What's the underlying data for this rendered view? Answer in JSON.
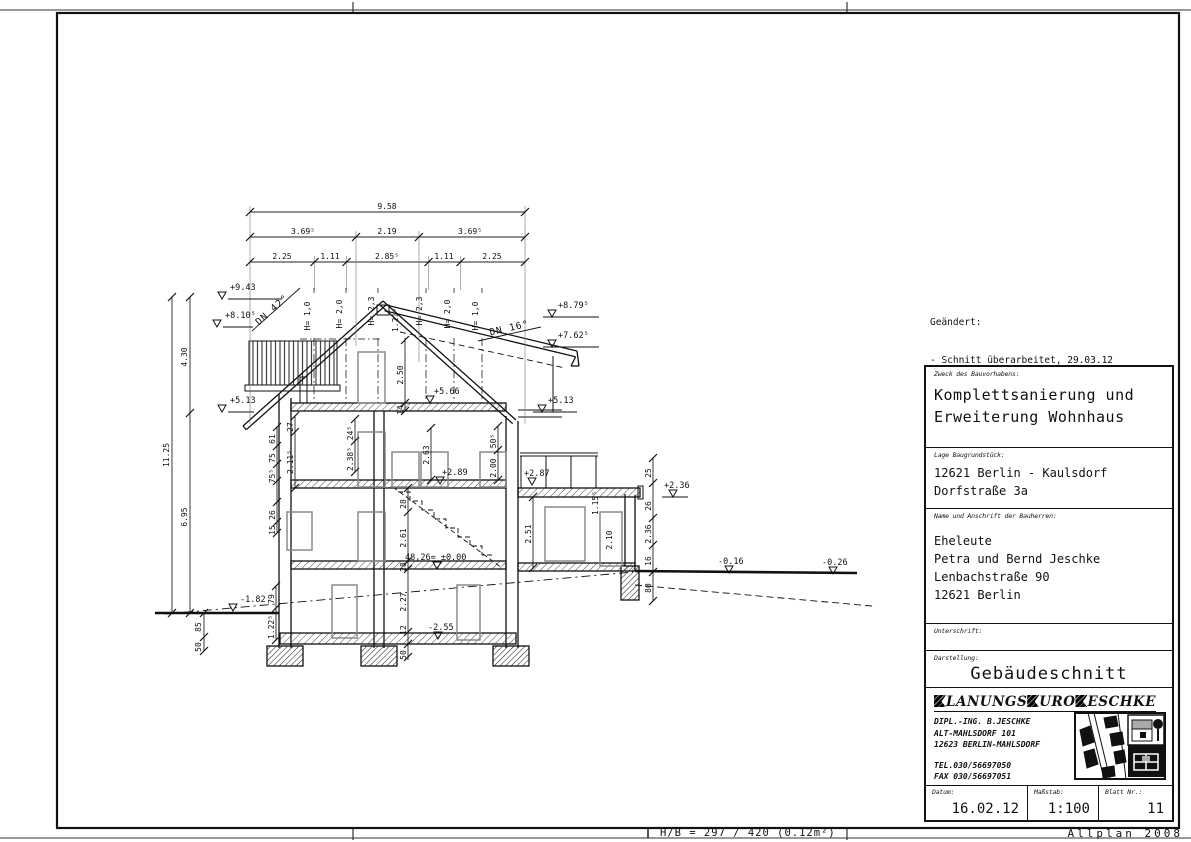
{
  "footer": {
    "format_label": "H/B = 297 / 420 (0.12m²)",
    "app_label": "Allplan 2008"
  },
  "revisions": {
    "title": "Geändert:",
    "items": [
      "- Schnitt überarbeitet, 29.03.12",
      "- Drempelwände verschoben, 20.04.12",
      "- Gemäß Statik überarbeitet, 19.06.12"
    ]
  },
  "titleblock": {
    "purpose_label": "Zweck des Bauvorhabens:",
    "purpose_line1": "Komplettsanierung und",
    "purpose_line2": "Erweiterung Wohnhaus",
    "site_label": "Lage Baugrundstück:",
    "site_line1": "12621 Berlin - Kaulsdorf",
    "site_line2": "Dorfstraße 3a",
    "owner_label": "Name und Anschrift der Bauherren:",
    "owner_lines": [
      "Eheleute",
      "Petra und Bernd Jeschke",
      "Lenbachstraße 90",
      "12621 Berlin"
    ],
    "signature_label": "Unterschrift:",
    "representation_label": "Darstellung:",
    "representation_value": "Gebäudeschnitt",
    "firm": {
      "seg1": "LANUNGS",
      "seg2": "URO",
      "seg3": "ESCHKE",
      "addr1": "DIPL.-ING. B.JESCHKE",
      "addr2": "ALT-MAHLSDORF 101",
      "addr3": "12623 BERLIN-MAHLSDORF",
      "tel": "TEL.030/56697050",
      "fax": "FAX 030/56697051"
    },
    "date_label": "Datum:",
    "date_value": "16.02.12",
    "scale_label": "Maßstab:",
    "scale_value": "1:100",
    "sheet_label": "Blatt Nr.:",
    "sheet_value": "11"
  },
  "drawing": {
    "top1": "9.58",
    "top2": [
      "3.69⁵",
      "2.19",
      "3.69⁵"
    ],
    "top3": [
      "2.25",
      "1.11",
      "2.85⁵",
      "1.11",
      "2.25"
    ],
    "left": {
      "total": "11.25",
      "upper": "4.30",
      "lower": "6.95",
      "b1": "85",
      "b2": "50"
    },
    "roof": {
      "left": "DN 42°",
      "right": "DN 16°",
      "ridge": "1.21⁵"
    },
    "drempel": [
      "H= 1,0",
      "H= 2,0",
      "H= 2,3",
      "H= 2,3",
      "H= 2,0",
      "H= 1,0"
    ],
    "levels": {
      "p943": "+9.43",
      "p810": "+8.10⁵",
      "p879": "+8.79⁵",
      "p762": "+7.62⁵",
      "p513": "+5.13",
      "p513r": "+5.13",
      "p566": "+5.66",
      "p289": "+2.89",
      "p287": "+2.87",
      "p236": "+2.36",
      "zero": "48,26= ±0.00",
      "m016": "-0.16",
      "m026": "-0.26",
      "m182": "-1.82",
      "m255": "-2.55"
    },
    "chains": {
      "a": [
        "61",
        "75",
        "75⁵",
        "26",
        "15"
      ],
      "b": [
        "27",
        "2.11⁵"
      ],
      "attic": [
        "2.50",
        "14"
      ],
      "d": [
        "24⁵",
        "2.38⁵"
      ],
      "e": [
        "2.63"
      ],
      "f": [
        "50⁵",
        "2.00"
      ],
      "g": [
        "28",
        "2.61",
        "28",
        "2.27",
        "12",
        "50"
      ],
      "k": [
        "79",
        "1.22⁵"
      ],
      "r": [
        "2.51"
      ],
      "annex_door": "2.10",
      "annex_roof": "1.15⁵",
      "n": [
        "25",
        "26",
        "2.36",
        "16",
        "80"
      ]
    }
  }
}
